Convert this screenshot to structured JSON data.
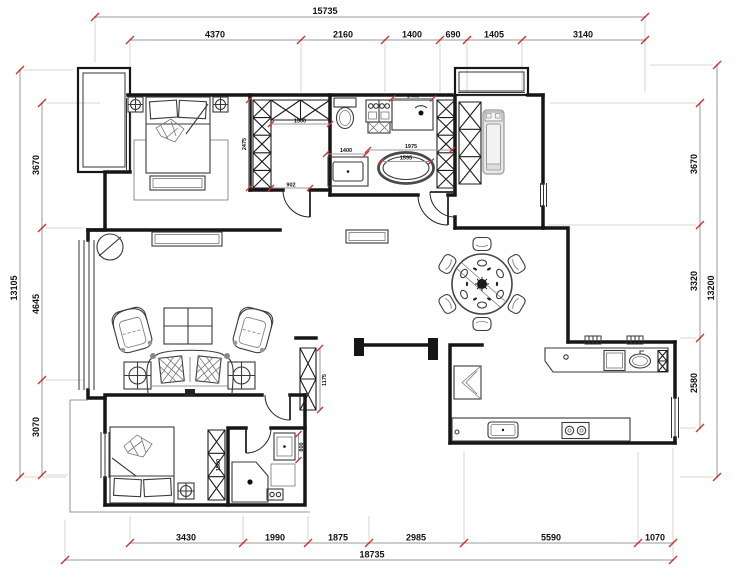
{
  "drawing": {
    "title": "apartment-floor-plan",
    "units": "mm"
  },
  "colors": {
    "wall": "#161616",
    "furniture": "#3a3a3a",
    "dim_line": "#9a9a9a",
    "dim_text": "#111111",
    "tick_red": "#cc3333",
    "gray_fill": "#e8e8e8"
  },
  "dimensions": {
    "top": {
      "overall": "15735",
      "segments": [
        "4370",
        "2160",
        "1400",
        "690",
        "1405",
        "3140"
      ]
    },
    "bottom": {
      "overall": "18735",
      "segments": [
        "3430",
        "1990",
        "1875",
        "2985",
        "5590",
        "1070"
      ]
    },
    "left": {
      "overall": "13105",
      "segments": [
        "3670",
        "4645",
        "3070"
      ]
    },
    "right": {
      "overall": "13200",
      "segments": [
        "3670",
        "3320",
        "2580"
      ]
    },
    "interior": {
      "closet_depth": "2475",
      "closet_width": "1500",
      "closet_door": "902",
      "vanity": "1400",
      "bathtub_zone": "1975",
      "bathtub": "1595",
      "shower": "1465",
      "hall_cabinet": "1175",
      "bedroom2_wardrobe": "1500",
      "basin": "800"
    }
  }
}
